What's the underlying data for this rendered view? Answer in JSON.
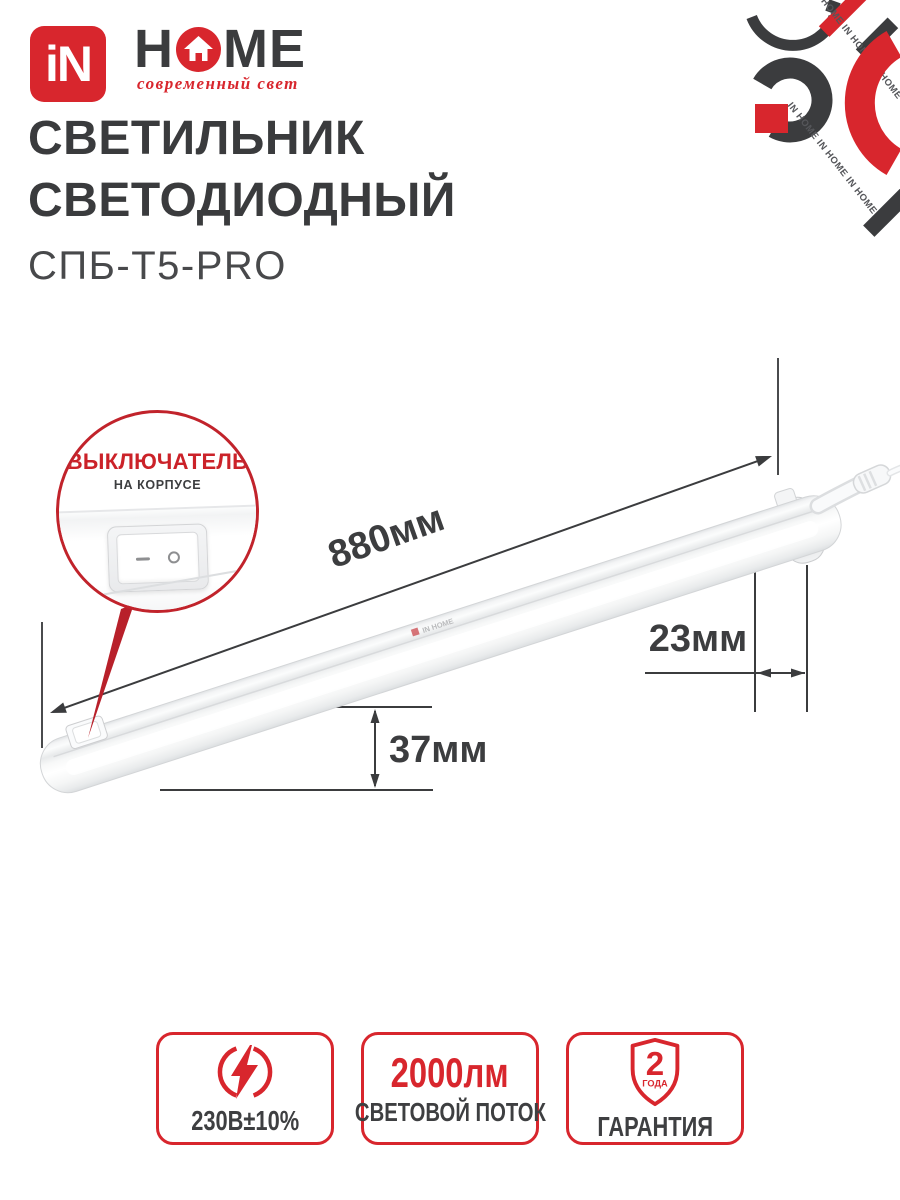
{
  "brand": {
    "logo_square_text": "iN",
    "logo_word_h": "H",
    "logo_word_me": "ME",
    "tagline": "современный свет",
    "watermark": "IN HOME",
    "watermark_row": "IN HOME  IN HOME  IN HOME"
  },
  "header": {
    "title_line1": "СВЕТИЛЬНИК",
    "title_line2": "СВЕТОДИОДНЫЙ",
    "model": "СПБ-Т5-PRO"
  },
  "callout": {
    "title": "ВЫКЛЮЧАТЕЛЬ",
    "subtitle": "НА КОРПУСЕ"
  },
  "dimensions": {
    "length": "880мм",
    "depth": "23мм",
    "height": "37мм"
  },
  "badges": {
    "voltage": {
      "label": "230В±10%"
    },
    "flux": {
      "value": "2000лм",
      "label": "СВЕТОВОЙ ПОТОК"
    },
    "warranty": {
      "value": "2",
      "unit": "ГОДА",
      "label": "ГАРАНТИЯ"
    }
  },
  "colors": {
    "accent_red": "#d8262d",
    "dark_text": "#3b3c3e"
  }
}
